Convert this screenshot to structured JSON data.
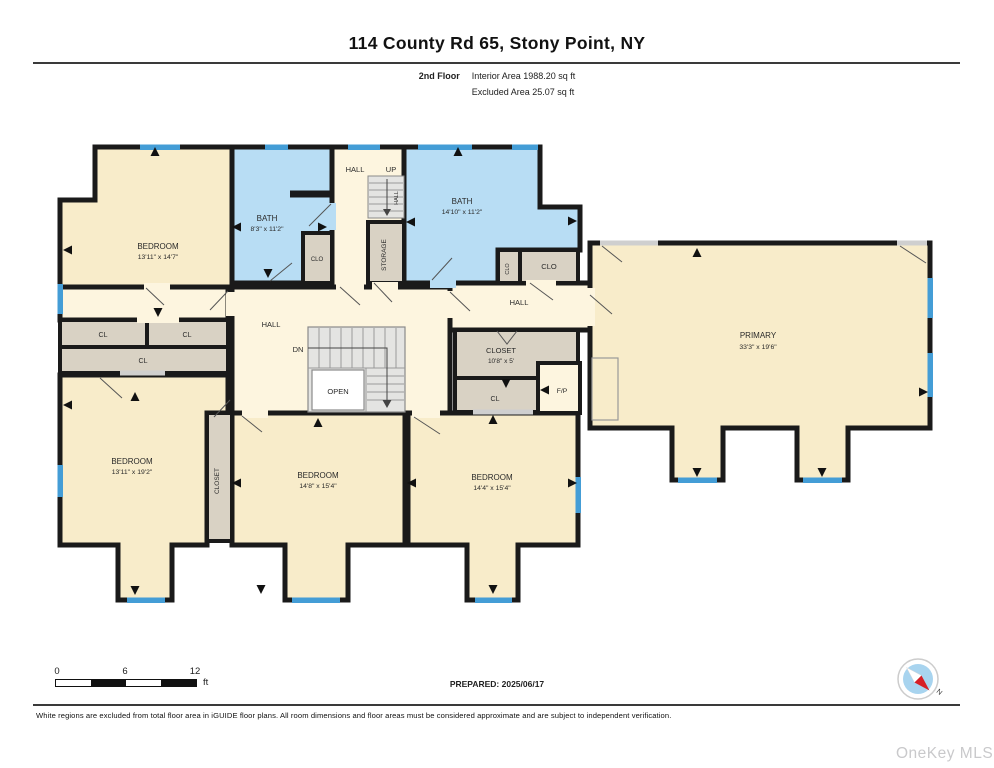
{
  "header": {
    "title": "114 County Rd 65, Stony Point, NY",
    "floor": "2nd Floor",
    "interior_area": "Interior Area 1988.20 sq ft",
    "excluded_area": "Excluded Area 25.07 sq ft"
  },
  "plan": {
    "rooms": {
      "bedroom_nw": {
        "name": "BEDROOM",
        "dims": "13'11\" x 14'7\""
      },
      "bath_nw": {
        "name": "BATH",
        "dims": "8'3\" x 11'2\""
      },
      "clo_nw": {
        "name": "CLO"
      },
      "hall_top": {
        "name": "HALL"
      },
      "up": {
        "name": "UP"
      },
      "stair_hall": {
        "name": "HALL"
      },
      "storage": {
        "name": "STORAGE"
      },
      "bath_ne": {
        "name": "BATH",
        "dims": "14'10\" x 11'2\""
      },
      "clo_small": {
        "name": "CLO"
      },
      "clo_big": {
        "name": "CLO"
      },
      "hall_ne": {
        "name": "HALL"
      },
      "primary": {
        "name": "PRIMARY",
        "dims": "33'3\" x 19'6\""
      },
      "cl_nw1": {
        "name": "CL"
      },
      "cl_nw2": {
        "name": "CL"
      },
      "cl_wide": {
        "name": "CL"
      },
      "hall_center": {
        "name": "HALL"
      },
      "dn": {
        "name": "DN"
      },
      "open": {
        "name": "OPEN"
      },
      "closet_center": {
        "name": "CLOSET",
        "dims": "10'8\" x 5'"
      },
      "cl_center": {
        "name": "CL"
      },
      "fp": {
        "name": "F/P"
      },
      "bedroom_sw": {
        "name": "BEDROOM",
        "dims": "13'11\" x 19'2\""
      },
      "closet_s": {
        "name": "CLOSET"
      },
      "bedroom_sm": {
        "name": "BEDROOM",
        "dims": "14'8\" x 15'4\""
      },
      "bedroom_se": {
        "name": "BEDROOM",
        "dims": "14'4\" x 15'4\""
      }
    },
    "colors": {
      "room_fill": "#f8ecca",
      "hall_fill": "#fdf5df",
      "bath_fill": "#b8ddf4",
      "closet_fill": "#d9d2c4",
      "stairs_fill": "#e4e4e2",
      "wall": "#1a1a1a",
      "window": "#449dd6"
    }
  },
  "scale_bar": {
    "tick0": "0",
    "tick1": "6",
    "tick2": "12",
    "unit": "ft"
  },
  "compass": {
    "label": "N"
  },
  "footer": {
    "prepared": "PREPARED: 2025/06/17",
    "disclaimer": "White regions are excluded from total floor area in iGUIDE floor plans. All room dimensions and floor areas must be considered approximate and are subject to independent verification."
  },
  "watermark": "OneKey MLS"
}
